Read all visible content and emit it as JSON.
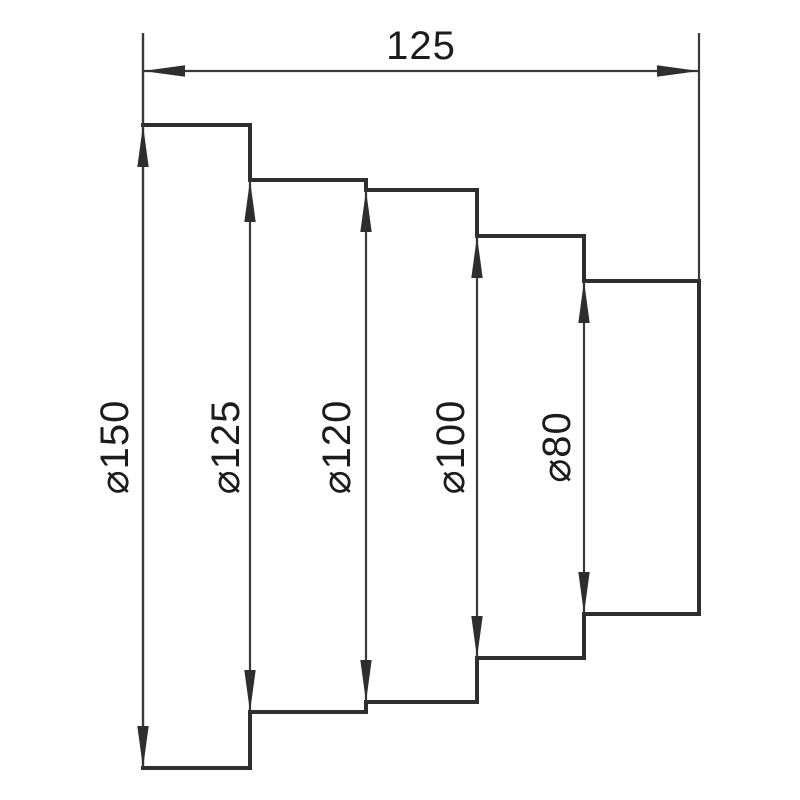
{
  "drawing": {
    "type": "stepped-shaft-dimension-drawing",
    "colors": {
      "background": "#ffffff",
      "outline": "#2e2e2e",
      "thin_line": "#3a3a3a",
      "arrow": "#2e2e2e",
      "text": "#1c1c1c"
    },
    "dimensions": {
      "length": {
        "label": "125",
        "value": 125
      },
      "diameters": [
        {
          "label": "⌀150",
          "symbol": "⌀",
          "value": 150
        },
        {
          "label": "⌀125",
          "symbol": "⌀",
          "value": 125
        },
        {
          "label": "⌀120",
          "symbol": "⌀",
          "value": 120
        },
        {
          "label": "⌀100",
          "symbol": "⌀",
          "value": 100
        },
        {
          "label": "⌀80",
          "symbol": "⌀",
          "value": 80
        }
      ]
    }
  }
}
